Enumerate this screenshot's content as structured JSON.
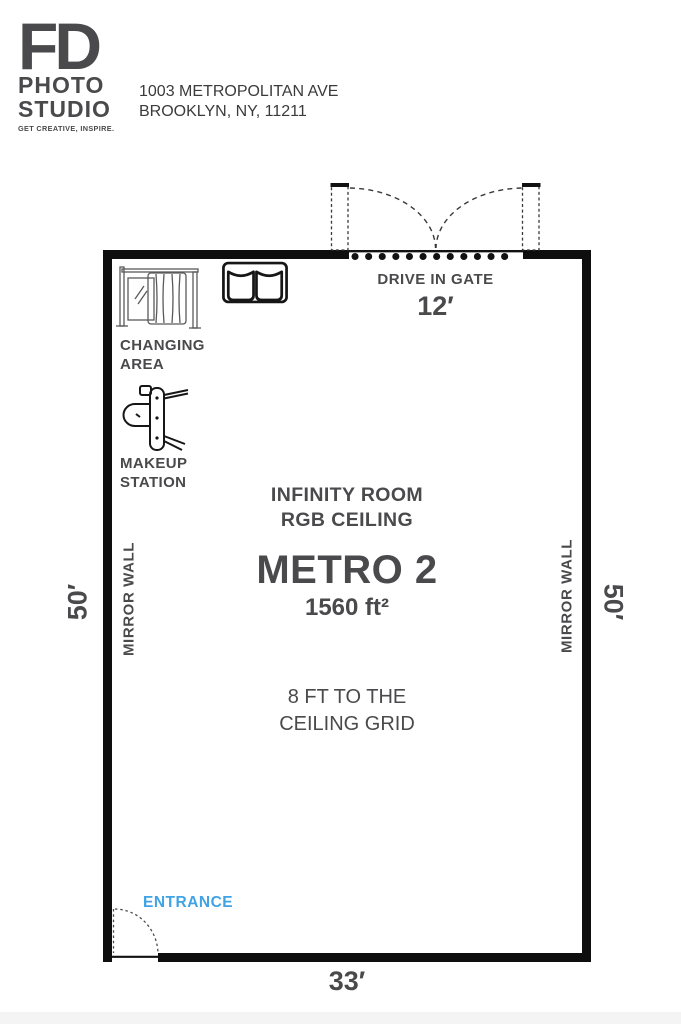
{
  "header": {
    "logo": {
      "fd": "FD",
      "photo": "PHOTO",
      "studio": "STUDIO",
      "tagline": "GET CREATIVE, INSPIRE."
    },
    "address": {
      "line1": "1003 METROPOLITAN AVE",
      "line2": "BROOKLYN, NY, 11211"
    }
  },
  "plan": {
    "gate": {
      "label": "DRIVE IN GATE",
      "width": "12′"
    },
    "changing_area": {
      "line1": "CHANGING",
      "line2": "AREA"
    },
    "makeup_station": {
      "line1": "MAKEUP",
      "line2": "STATION"
    },
    "room": {
      "feature1": "INFINITY ROOM",
      "feature2": "RGB CEILING",
      "name": "METRO 2",
      "area": "1560 ft²",
      "ceiling1": "8 FT TO THE",
      "ceiling2": "CEILING GRID"
    },
    "walls": {
      "left_label": "MIRROR WALL",
      "right_label": "MIRROR WALL"
    },
    "dimensions": {
      "left": "50′",
      "right": "50′",
      "bottom": "33′"
    },
    "entrance": {
      "label": "ENTRANCE"
    },
    "icons": {
      "changing": "curtain-mirror-divider-icon",
      "sofa": "sofa-icon",
      "makeup": "makeup-chair-and-table-icon",
      "gate_doors": "double-swing-gate-doors-icon",
      "entrance_door": "single-swing-door-icon"
    },
    "colors": {
      "accent_blue": "#3fa3e4",
      "text_gray": "#4a4a4c",
      "wall_black": "#0e0e0e"
    }
  }
}
